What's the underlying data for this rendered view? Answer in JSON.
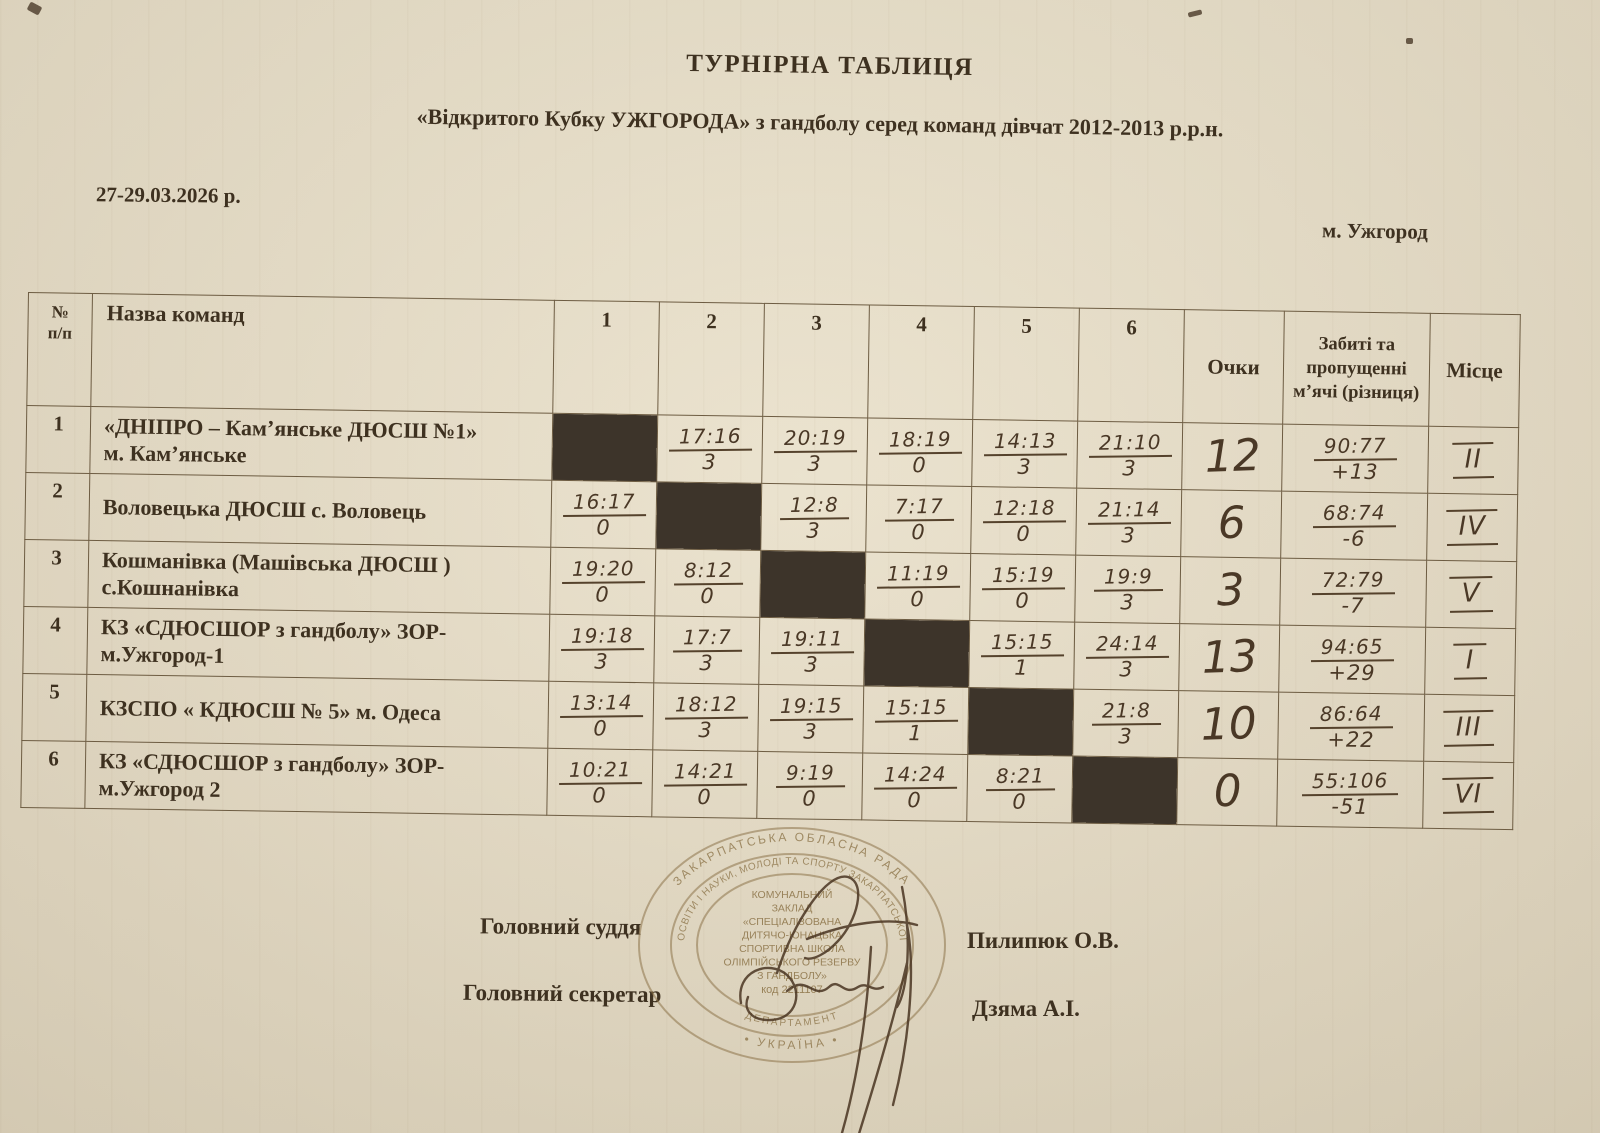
{
  "document": {
    "title": "ТУРНІРНА ТАБЛИЦЯ",
    "subtitle": "«Відкритого  Кубку УЖГОРОДА»  з гандболу серед команд дівчат 2012-2013 р.р.н.",
    "date": "27-29.03.2026 р.",
    "city": "м.  Ужгород"
  },
  "colors": {
    "paper": "#e9e0cb",
    "printed_ink": "#3e3120",
    "pen_ink": "#4a3826",
    "blackout_cell": "#3d342a",
    "table_line": "#6d5c42",
    "stamp": "#8c7348"
  },
  "table": {
    "headers": {
      "num": "№\nп/п",
      "team": "Назва команд",
      "rounds": [
        "1",
        "2",
        "3",
        "4",
        "5",
        "6"
      ],
      "points": "Очки",
      "goals": "Забиті та пропущенні м’ячі (різниця)",
      "place": "Місце"
    },
    "rows": [
      {
        "num": "1",
        "name": "«ДНІПРО – Кам’янське  ДЮСШ №1»",
        "name2": "м. Кам’янське",
        "results": [
          null,
          {
            "s": "17:16",
            "p": "3"
          },
          {
            "s": "20:19",
            "p": "3"
          },
          {
            "s": "18:19",
            "p": "0"
          },
          {
            "s": "14:13",
            "p": "3"
          },
          {
            "s": "21:10",
            "p": "3"
          }
        ],
        "points": "12",
        "goals": "90:77",
        "diff": "+13",
        "place": "II"
      },
      {
        "num": "2",
        "name": "Воловецька ДЮСШ с. Воловець",
        "name2": "",
        "results": [
          {
            "s": "16:17",
            "p": "0"
          },
          null,
          {
            "s": "12:8",
            "p": "3"
          },
          {
            "s": "7:17",
            "p": "0"
          },
          {
            "s": "12:18",
            "p": "0"
          },
          {
            "s": "21:14",
            "p": "3"
          }
        ],
        "points": "6",
        "goals": "68:74",
        "diff": "-6",
        "place": "IV"
      },
      {
        "num": "3",
        "name": "Кошманівка (Машівська ДЮСШ )",
        "name2": "с.Кошнанівка",
        "results": [
          {
            "s": "19:20",
            "p": "0"
          },
          {
            "s": "8:12",
            "p": "0"
          },
          null,
          {
            "s": "11:19",
            "p": "0"
          },
          {
            "s": "15:19",
            "p": "0"
          },
          {
            "s": "19:9",
            "p": "3"
          }
        ],
        "points": "3",
        "goals": "72:79",
        "diff": "-7",
        "place": "V"
      },
      {
        "num": "4",
        "name": "КЗ «СДЮСШОР з гандболу» ЗОР-",
        "name2": "м.Ужгород-1",
        "results": [
          {
            "s": "19:18",
            "p": "3"
          },
          {
            "s": "17:7",
            "p": "3"
          },
          {
            "s": "19:11",
            "p": "3"
          },
          null,
          {
            "s": "15:15",
            "p": "1"
          },
          {
            "s": "24:14",
            "p": "3"
          }
        ],
        "points": "13",
        "goals": "94:65",
        "diff": "+29",
        "place": "I"
      },
      {
        "num": "5",
        "name": "КЗСПО « КДЮСШ № 5» м. Одеса",
        "name2": "",
        "results": [
          {
            "s": "13:14",
            "p": "0"
          },
          {
            "s": "18:12",
            "p": "3"
          },
          {
            "s": "19:15",
            "p": "3"
          },
          {
            "s": "15:15",
            "p": "1"
          },
          null,
          {
            "s": "21:8",
            "p": "3"
          }
        ],
        "points": "10",
        "goals": "86:64",
        "diff": "+22",
        "place": "III"
      },
      {
        "num": "6",
        "name": "КЗ «СДЮСШОР з гандболу» ЗОР-",
        "name2": "м.Ужгород 2",
        "results": [
          {
            "s": "10:21",
            "p": "0"
          },
          {
            "s": "14:21",
            "p": "0"
          },
          {
            "s": "9:19",
            "p": "0"
          },
          {
            "s": "14:24",
            "p": "0"
          },
          {
            "s": "8:21",
            "p": "0"
          },
          null
        ],
        "points": "0",
        "goals": "55:106",
        "diff": "-51",
        "place": "VI"
      }
    ]
  },
  "signatures": {
    "judge_label": "Головний суддя",
    "judge_name": "Пилипюк О.В.",
    "secretary_label": "Головний секретар",
    "secretary_name": "Дзяма А.І."
  },
  "stamp": {
    "ring_top": "ЗАКАРПАТСЬКА ОБЛАСНА РАДА",
    "ring_bottom": "• УКРАЇНА •",
    "ring_inner_top": "ОСВІТИ І НАУКИ, МОЛОДІ ТА СПОРТУ ЗАКАРПАТСЬКОЇ",
    "ring_inner_bottom": "ДЕПАРТАМЕНТ",
    "center_lines": [
      "КОМУНАЛЬНИЙ",
      "ЗАКЛАД",
      "«СПЕЦІАЛІЗОВАНА",
      "ДИТЯЧО-ЮНАЦЬКА",
      "СПОРТИВНА ШКОЛА",
      "ОЛІМПІЙСЬКОГО РЕЗЕРВУ",
      "З ГАНДБОЛУ»",
      "код 2211107"
    ]
  }
}
